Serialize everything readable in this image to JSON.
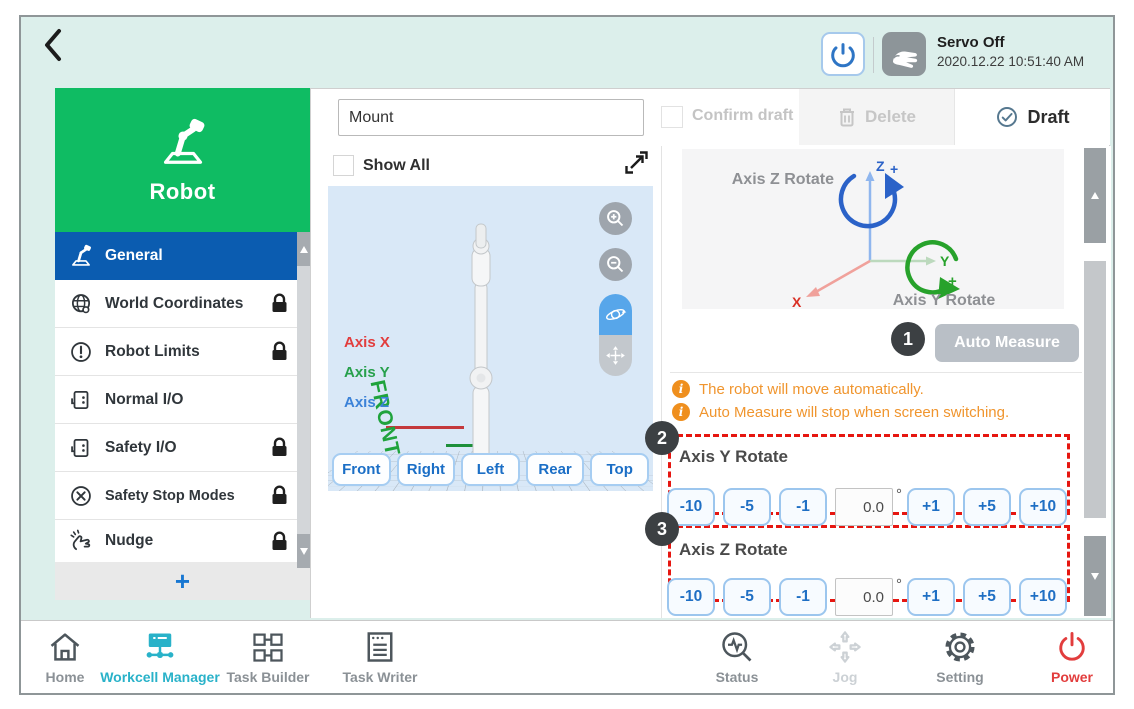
{
  "header": {
    "servo_status": "Servo Off",
    "timestamp": "2020.12.22 10:51:40 AM"
  },
  "sidebar": {
    "title": "Robot",
    "add_label": "+",
    "items": [
      {
        "label": "General"
      },
      {
        "label": "World Coordinates"
      },
      {
        "label": "Robot Limits"
      },
      {
        "label": "Normal I/O"
      },
      {
        "label": "Safety I/O"
      },
      {
        "label": "Safety Stop Modes"
      },
      {
        "label": "Nudge"
      }
    ]
  },
  "toolbar": {
    "name_value": "Mount",
    "confirm_draft_label": "Confirm draft",
    "delete_label": "Delete",
    "draft_label": "Draft"
  },
  "viewer": {
    "show_all_label": "Show All",
    "axis_x": "Axis X",
    "axis_y": "Axis Y",
    "axis_z": "Axis Z",
    "floor_label": "FRONT",
    "view_buttons": [
      "Front",
      "Right",
      "Left",
      "Rear",
      "Top"
    ]
  },
  "measure": {
    "diagram": {
      "axis_z_rotate": "Axis Z Rotate",
      "axis_y_rotate": "Axis Y Rotate",
      "z": "Z",
      "y": "Y",
      "x": "X",
      "plus": "+"
    },
    "auto_measure_label": "Auto Measure",
    "callouts": [
      "1",
      "2",
      "3"
    ],
    "notices": [
      "The robot will move automatically.",
      "Auto Measure will stop when screen switching."
    ],
    "sections": [
      {
        "title": "Axis Y Rotate",
        "neg": [
          "-10",
          "-5",
          "-1"
        ],
        "value": "0.0",
        "unit": "°",
        "pos": [
          "+1",
          "+5",
          "+10"
        ]
      },
      {
        "title": "Axis Z Rotate",
        "neg": [
          "-10",
          "-5",
          "-1"
        ],
        "value": "0.0",
        "unit": "°",
        "pos": [
          "+1",
          "+5",
          "+10"
        ]
      }
    ]
  },
  "bottom_nav": {
    "items": [
      {
        "label": "Home"
      },
      {
        "label": "Workcell Manager"
      },
      {
        "label": "Task Builder"
      },
      {
        "label": "Task Writer"
      },
      {
        "label": "Status"
      },
      {
        "label": "Jog"
      },
      {
        "label": "Setting"
      },
      {
        "label": "Power"
      }
    ]
  },
  "colors": {
    "accent_green": "#0fbc63",
    "selected_blue": "#0b5cb0",
    "button_blue": "#1f6fc4",
    "callout_red": "#e61610",
    "notice_orange": "#f0952e",
    "active_teal": "#29b2c9",
    "power_red": "#e23d3d"
  }
}
